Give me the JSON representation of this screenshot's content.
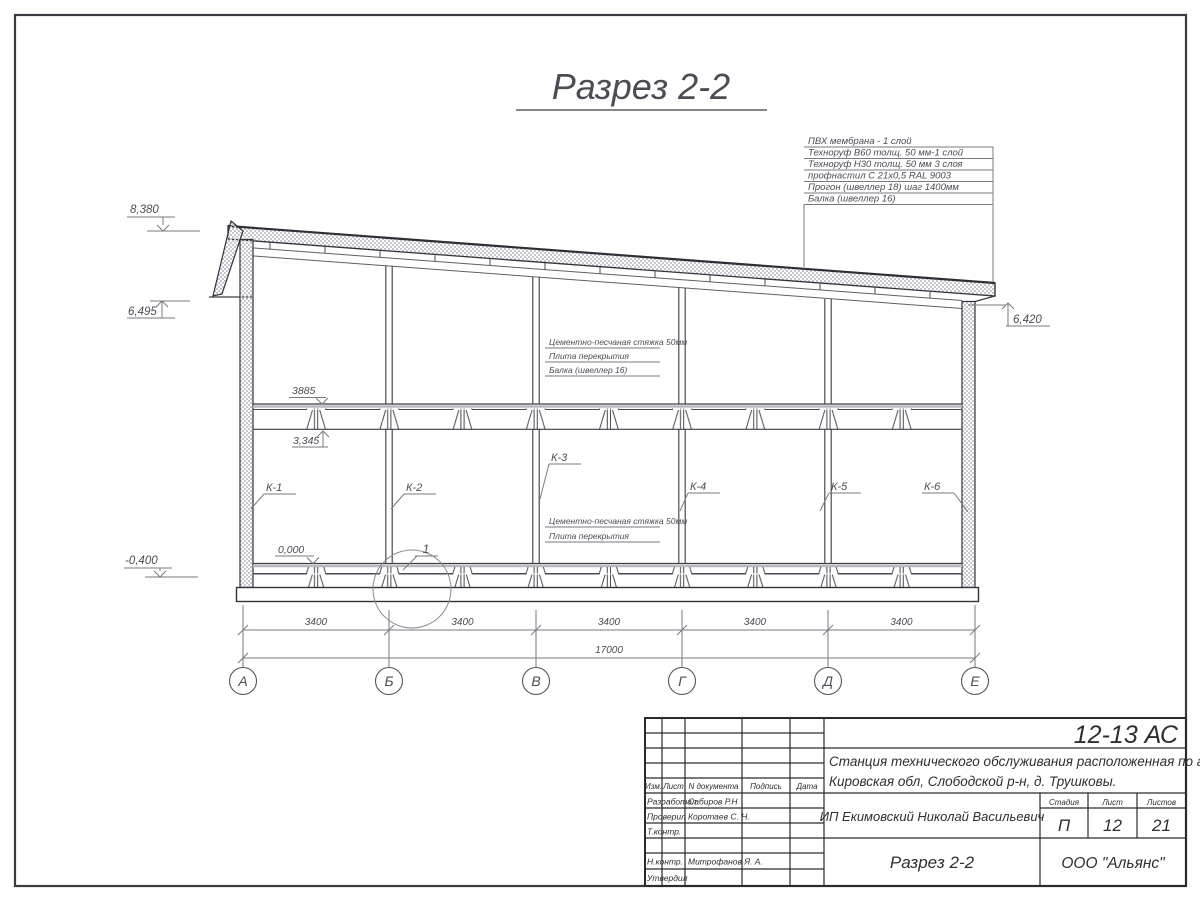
{
  "title": {
    "text": "Разрез 2-2"
  },
  "roof_callout": {
    "lines": [
      "ПВХ мембрана - 1 слой",
      "Техноруф В60 толщ. 50 мм-1 слой",
      "Техноруф Н30 толщ. 50 мм 3 слоя",
      "профнастил С 21х0,5 RAL 9003",
      "Прогон (швеллер 18) шаг 1400мм",
      "Балка (швеллер 16)"
    ]
  },
  "elevations": {
    "left_top": "8,380",
    "left_mid": "6,495",
    "left_bottom": "-0,400",
    "right": "6,420",
    "floor_top": "3885",
    "floor_bottom": "3,345",
    "ground": "0,000"
  },
  "slab_notes": {
    "upper": [
      "Цементно-песчаная стяжка 50мм",
      "Плита перекрытия",
      "Балка (швеллер 16)"
    ],
    "lower": [
      "Цементно-песчаная стяжка 50мм",
      "Плита перекрытия"
    ]
  },
  "column_labels": [
    "К-1",
    "К-2",
    "К-3",
    "К-4",
    "К-5",
    "К-6"
  ],
  "detail": {
    "label": "1"
  },
  "dims": {
    "bays": [
      "3400",
      "3400",
      "3400",
      "3400",
      "3400"
    ],
    "total": "17000"
  },
  "axes": [
    "А",
    "Б",
    "В",
    "Г",
    "Д",
    "Е"
  ],
  "title_block": {
    "doc_code": "12-13 АС",
    "project_line1": "Станция технического обслуживания расположенная по адресу",
    "project_line2": "Кировская обл, Слободской р-н, д. Трушковы.",
    "client": "ИП Екимовский Николай Васильевич",
    "drawing_name": "Разрез 2-2",
    "company": "ООО \"Альянс\"",
    "stage_label": "Стадия",
    "stage": "П",
    "sheet_label": "Лист",
    "sheet": "12",
    "sheets_label": "Листов",
    "sheets": "21",
    "header": {
      "izm": "Изм.",
      "list": "Лист",
      "ndoc": "N документа",
      "podpis": "Подпись",
      "data": "Дата"
    },
    "roles": [
      {
        "label": "Разработал",
        "name": "Сабиров Р.Н"
      },
      {
        "label": "Проверил",
        "name": "Коротаев С. Н."
      },
      {
        "label": "Т.контр.",
        "name": ""
      },
      {
        "label": "Н.контр.",
        "name": "Митрофанов Я. А."
      },
      {
        "label": "Утвердил",
        "name": ""
      }
    ]
  }
}
